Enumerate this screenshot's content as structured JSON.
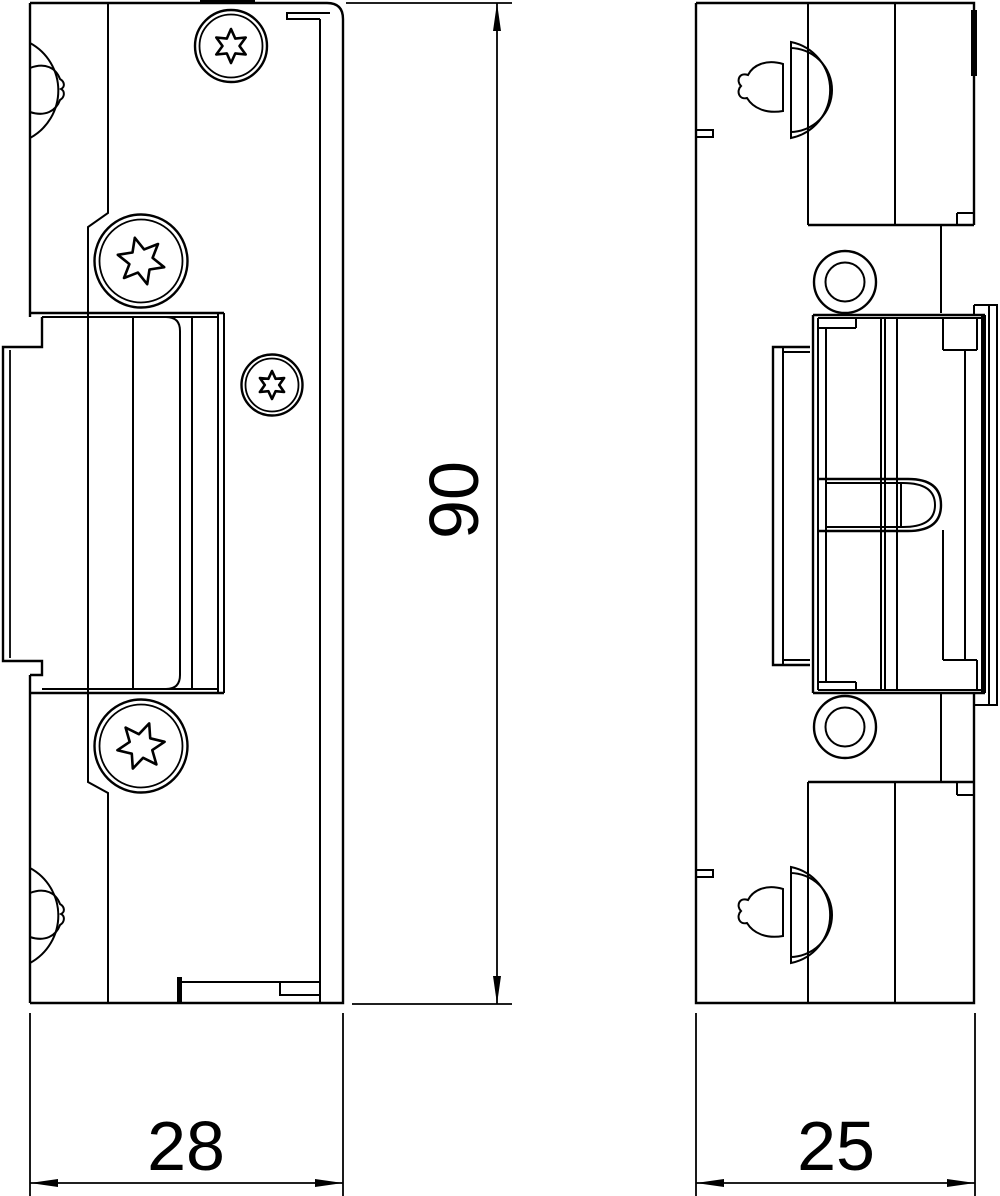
{
  "drawing": {
    "type": "technical-drawing-two-views",
    "colors": {
      "line": "#000000",
      "background": "#ffffff"
    },
    "dimensions": {
      "height": "90",
      "front_width": "28",
      "side_width": "25"
    }
  }
}
